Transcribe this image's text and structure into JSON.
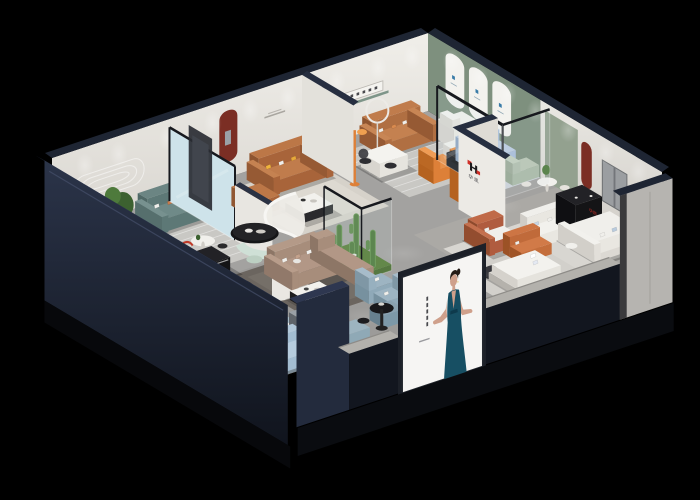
{
  "meta": {
    "kind": "3d-isometric-cutaway-render",
    "subject": "furniture showroom interior dollhouse view on black background"
  },
  "brand": {
    "logo_letter": "H",
    "logo_text": "华凯"
  },
  "poster": {
    "subject": "woman in teal evening dress, arms outstretched",
    "background": "#f6f5f3",
    "text_style": "small vertical caption column (illegible)"
  },
  "palette": {
    "background": "#000000",
    "ceilingBand": "#1e2533",
    "ceilingBandLight": "#2e3750",
    "exteriorNavy": "#232b3d",
    "exteriorNavyDark": "#12161f",
    "exteriorGray": "#b6b4b0",
    "wallWhite": "#eae8e3",
    "wallShade": "#dcd9d3",
    "wallDim": "#c6c3bd",
    "greenWall": "#7e907e",
    "sageNiche": "#93a18f",
    "floorGray": "#a3a2a0",
    "nicheRed": "#7b2e24",
    "rugLight": "#c9c8c4",
    "rugBeige": "#d6d2ca",
    "rugDark": "#6b655f",
    "rugBlue": "#a6bac6",
    "rugPale": "#ccd2d8",
    "tealSofa": "#5d7876",
    "cognacSofa": "#a8643a",
    "caramelSofa": "#b06f42",
    "taupeSofa": "#a78d7b",
    "taupeBack": "#b49a88",
    "blueSofa": "#a9bdd8",
    "paleBlueSofa": "#a3bdd2",
    "whiteSofa": "#e9e7e1",
    "mintBench": "#cfe0d6",
    "sageSofa": "#b9c6b4",
    "orange": "#dd8038",
    "rust": "#b05c3f",
    "plantGreen": "#4e7a3c",
    "plantDark": "#3c6130",
    "frameDark": "#17191e",
    "blackFurniture": "#141416",
    "white": "#f4f3f1",
    "logoRed": "#d03028",
    "skin": "#cfa08b",
    "dress": "#174f63",
    "hair": "#241b16"
  },
  "rooms": [
    {
      "name": "teal-sofa-lounge",
      "items": "teal 3-seat sofa, capsule wall decor, plant, round white table, striped rug, orange armchair"
    },
    {
      "name": "cognac-leather-lounge",
      "items": "cognac sofa and armchair, red arched wall niche, black/white coffee table, glass divider"
    },
    {
      "name": "caramel-sofa-showroom",
      "items": "caramel sofa, white armchair, ring floor lamp, letter shelf, white desk, orange chaise and cabinet"
    },
    {
      "name": "arched-green-gallery",
      "items": "sage wall with three white arches and small blue logos"
    },
    {
      "name": "glass-cube-room",
      "items": "periwinkle sofa, sage bench, dark console, glass partitions"
    },
    {
      "name": "central-showroom",
      "items": "curved white partition, mint bench, black oval table, taupe sectional, cactus terrarium, media console"
    },
    {
      "name": "right-wing-suites",
      "items": "white sofa groups, red arch niche, window panel, black display cabinets, rust armchair, logo wall"
    },
    {
      "name": "front-bedroom",
      "items": "white bed, dark round rug, rust-orange sofa"
    },
    {
      "name": "front-left-dining",
      "items": "black oval dining table, cream chairs and stools, shelving, red floor lamp, consoles, pale blue sofa"
    }
  ]
}
